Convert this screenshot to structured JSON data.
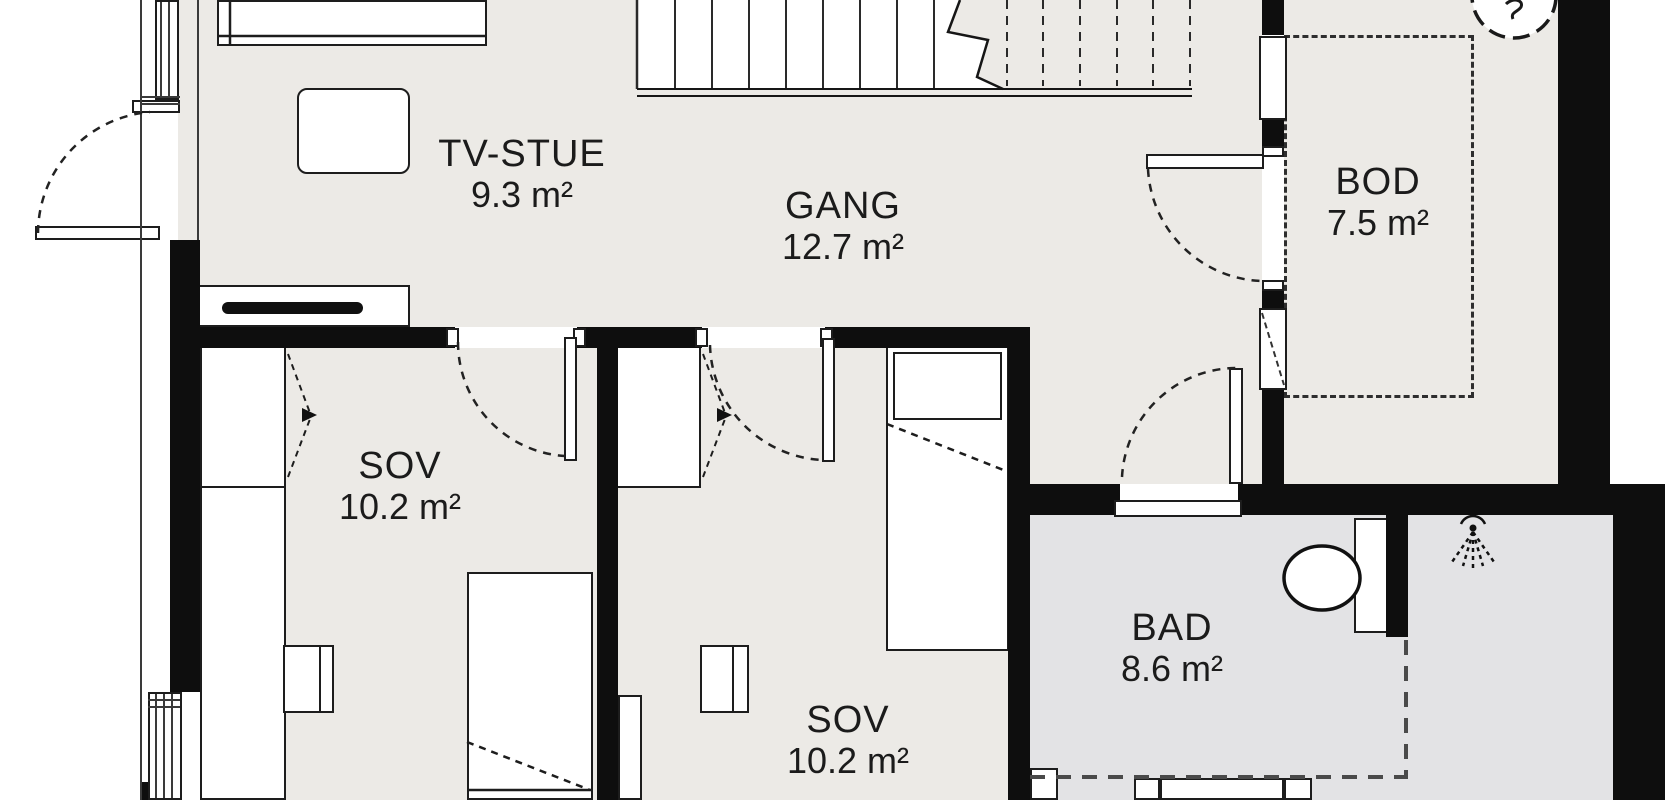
{
  "plan": {
    "title": "Floor plan",
    "rooms": [
      {
        "id": "tvstue",
        "name": "TV-STUE",
        "area": "9.3 m²"
      },
      {
        "id": "gang",
        "name": "GANG",
        "area": "12.7 m²"
      },
      {
        "id": "bod",
        "name": "BOD",
        "area": "7.5 m²"
      },
      {
        "id": "sov1",
        "name": "SOV",
        "area": "10.2 m²"
      },
      {
        "id": "sov2",
        "name": "SOV",
        "area": "10.2 m²"
      },
      {
        "id": "bad",
        "name": "BAD",
        "area": "8.6 m²"
      }
    ],
    "colors": {
      "wall": "#0e0e0e",
      "floor_main": "#eceae6",
      "floor_bath": "#e3e3e5",
      "line": "#1d1d1d",
      "background": "#ffffff"
    },
    "icons": [
      "shower-head-icon",
      "compass-icon"
    ],
    "furniture": [
      "bed",
      "sofa-table",
      "tv-bench",
      "tv",
      "wardrobe",
      "desk-with-chair",
      "stairs",
      "toilet",
      "vanity-cabinet"
    ]
  }
}
